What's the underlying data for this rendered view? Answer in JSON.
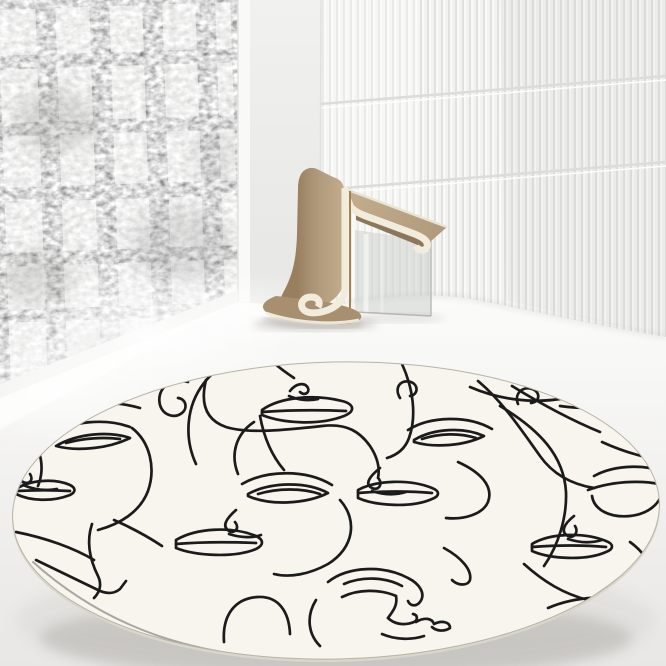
{
  "scene": {
    "title": "Minimalist interior with round one-line face-art rug",
    "style": "product photography",
    "elements": [
      "frosted grid window",
      "fluted wall panel",
      "curved ribbon chair",
      "round art rug"
    ]
  },
  "window": {
    "type": "grid window with frosted glass",
    "columns": 5,
    "rows": 6
  },
  "fluted_wall": {
    "type": "vertical fluted panels",
    "seams": 2
  },
  "chair": {
    "type": "curved ribbon chair",
    "material": "tan wood with cream trim",
    "leg": "clear acrylic"
  },
  "rug": {
    "shape": "round",
    "pattern": "continuous one-line abstract female faces",
    "faces": 6
  },
  "colors": {
    "wall_flat": "#f1f1ef",
    "wall_flat_dark": "#e6e6e4",
    "window_frame": "#f9f9f7",
    "glass": "#c7c7c5",
    "flute_base": "#f2f2f0",
    "flute_shadow": "#e1e1df",
    "flute_light": "#fbfbfa",
    "floor_top": "#fbfbfa",
    "floor_bottom": "#e8e7e5",
    "rug_base": "#f7f5ee",
    "rug_line": "#1b1b1b",
    "rug_edge": "#d9d6cb",
    "chair_body": "#b19a7c",
    "chair_body_dark": "#997f60",
    "chair_body_light": "#c3ad8d",
    "chair_trim": "#f2ecdd",
    "chair_bronze": "#a5824e",
    "acrylic": "#c9cdca"
  }
}
